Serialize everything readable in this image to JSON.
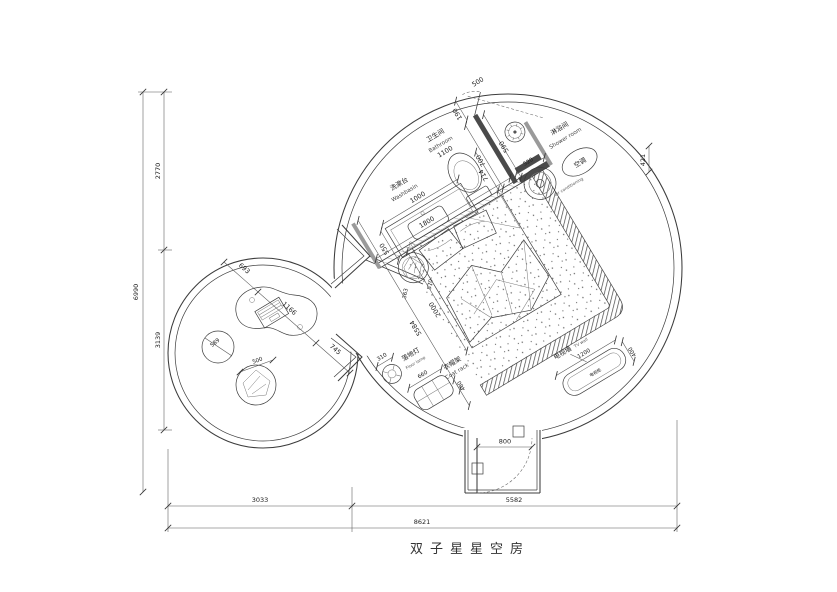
{
  "title": "双子星星空房",
  "dims": {
    "total_h": "6990",
    "h_top": "2770",
    "h_bottom": "3139",
    "w_left": "3033",
    "w_right": "5582",
    "total_w": "8621"
  },
  "entry": {
    "door": "800"
  },
  "bathroom": {
    "label_cn": "卫生间",
    "label_en": "Bathroom",
    "width": "1100",
    "washbasin_cn": "洗漱台",
    "washbasin_en": "Washbasin",
    "washbasin_w": "1000",
    "d550": "550",
    "d714": "714",
    "d1800": "1800",
    "d190": "190",
    "d700": "700",
    "d590": "590",
    "door": "500"
  },
  "shower": {
    "label_cn": "淋浴间",
    "label_en": "Shower room"
  },
  "ac": {
    "label_cn": "空调",
    "label_en": "air conditioning",
    "d520": "520",
    "d421": "421"
  },
  "bed": {
    "d2000": "2000",
    "d5584": "5584",
    "d363": "363",
    "d570": "570"
  },
  "lamp": {
    "label_cn": "落地灯",
    "label_en": "Floor lamp",
    "dia": "310"
  },
  "coat": {
    "label_cn": "衣帽架",
    "label_en": "Coat rack",
    "w": "660",
    "d": "400"
  },
  "tv": {
    "wall_cn": "电视墙",
    "wall_en": "TV wall",
    "w": "1200",
    "d": "400",
    "cabinet": "电视柜"
  },
  "lounge": {
    "d693": "693",
    "d1166": "1166",
    "d745": "745",
    "pouf": "589",
    "chair": "500"
  }
}
